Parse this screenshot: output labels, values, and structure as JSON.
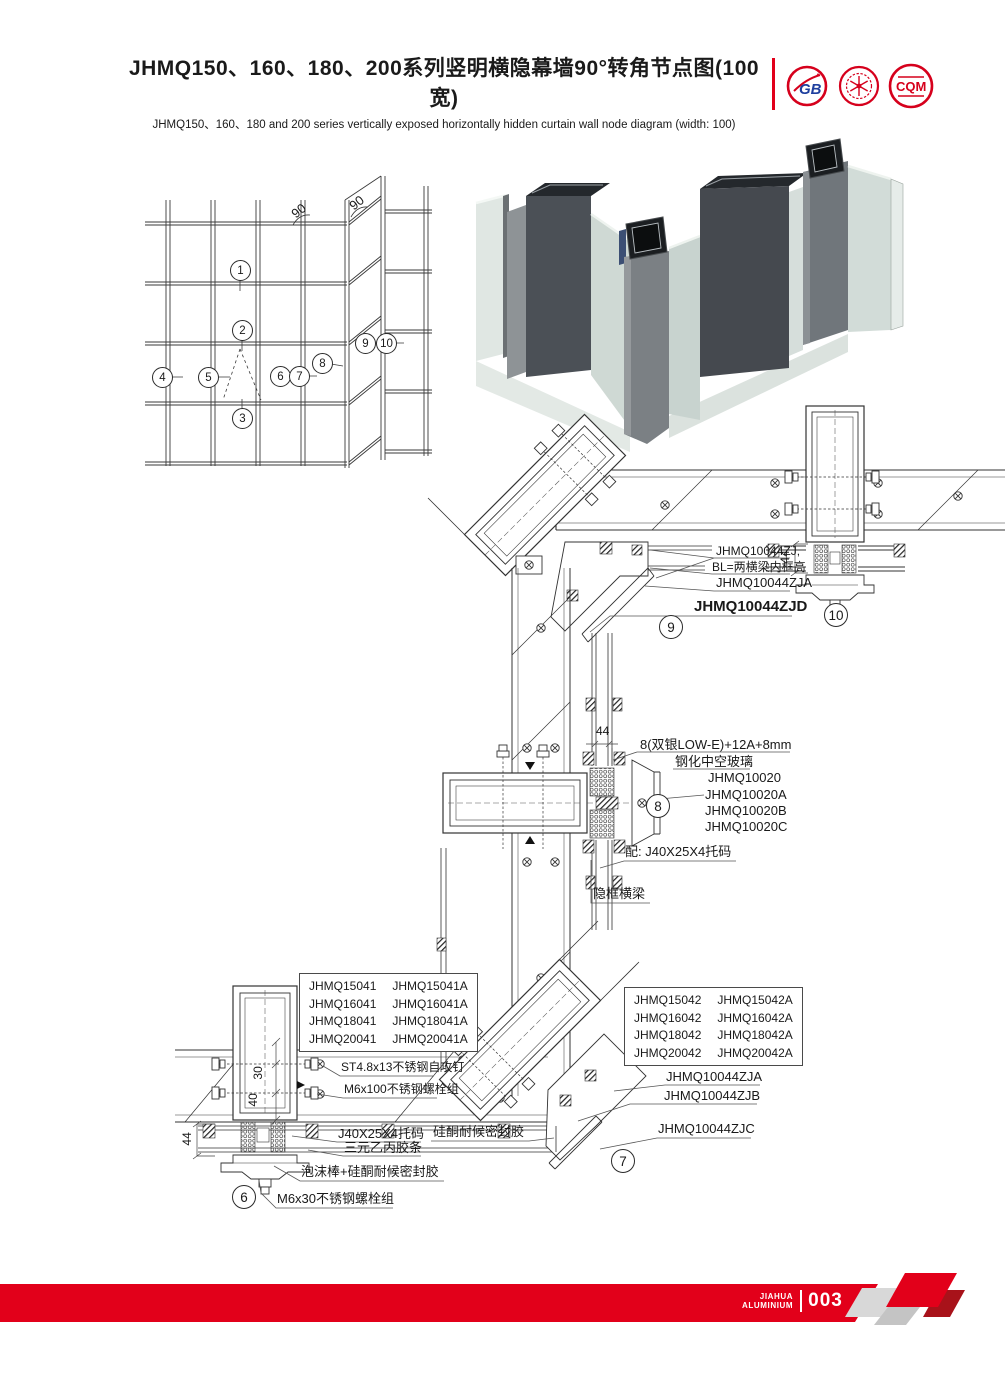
{
  "header": {
    "title_cn": "JHMQ150、160、180、200系列竖明横隐幕墙90°转角节点图(100宽)",
    "title_en": "JHMQ150、160、180 and 200 series vertically exposed horizontally hidden curtain wall node diagram (width: 100)",
    "logos": {
      "logo1": "GB",
      "logo3": "CQM"
    }
  },
  "elevation": {
    "angles": [
      "90",
      "90"
    ],
    "callouts": [
      "1",
      "2",
      "3",
      "4",
      "5",
      "6",
      "7",
      "8",
      "9",
      "10"
    ]
  },
  "d9": {
    "callout": "9",
    "labels": [
      "JHMQ10044ZJ,",
      "BL=两横梁内框高",
      "JHMQ10044ZJA",
      "JHMQ10044ZJD"
    ]
  },
  "d10": {
    "callout": "10",
    "dim_44": "44"
  },
  "d8": {
    "callout": "8",
    "dim_44": "44",
    "labels": [
      "8(双银LOW-E)+12A+8mm",
      "钢化中空玻璃",
      "JHMQ10020",
      "JHMQ10020A",
      "JHMQ10020B",
      "JHMQ10020C",
      "配: J40X25X4托码",
      "隐框横梁"
    ]
  },
  "d6": {
    "callout": "6",
    "dim_44": "44",
    "dim_40": "40",
    "dim_30": "30",
    "labels": [
      "ST4.8x13不锈钢自攻钉",
      "M6x100不锈钢螺栓组",
      "J40X25X4托码",
      "三元乙丙胶条",
      "泡沫棒+硅酮耐候密封胶",
      "M6x30不锈钢螺栓组"
    ],
    "table": [
      [
        "JHMQ15041",
        "JHMQ15041A"
      ],
      [
        "JHMQ16041",
        "JHMQ16041A"
      ],
      [
        "JHMQ18041",
        "JHMQ18041A"
      ],
      [
        "JHMQ20041",
        "JHMQ20041A"
      ]
    ]
  },
  "d7": {
    "callout": "7",
    "labels": [
      "JHMQ10044ZJA",
      "JHMQ10044ZJB",
      "JHMQ10044ZJC",
      "硅酮耐候密封胶"
    ],
    "table": [
      [
        "JHMQ15042",
        "JHMQ15042A"
      ],
      [
        "JHMQ16042",
        "JHMQ16042A"
      ],
      [
        "JHMQ18042",
        "JHMQ18042A"
      ],
      [
        "JHMQ20042",
        "JHMQ20042A"
      ]
    ]
  },
  "footer": {
    "brand_top": "JIAHUA",
    "brand_bottom": "ALUMINIUM",
    "page": "003"
  },
  "colors": {
    "accent_red": "#e2001a",
    "dark_red": "#a8121a",
    "line": "#2f2f2f"
  }
}
